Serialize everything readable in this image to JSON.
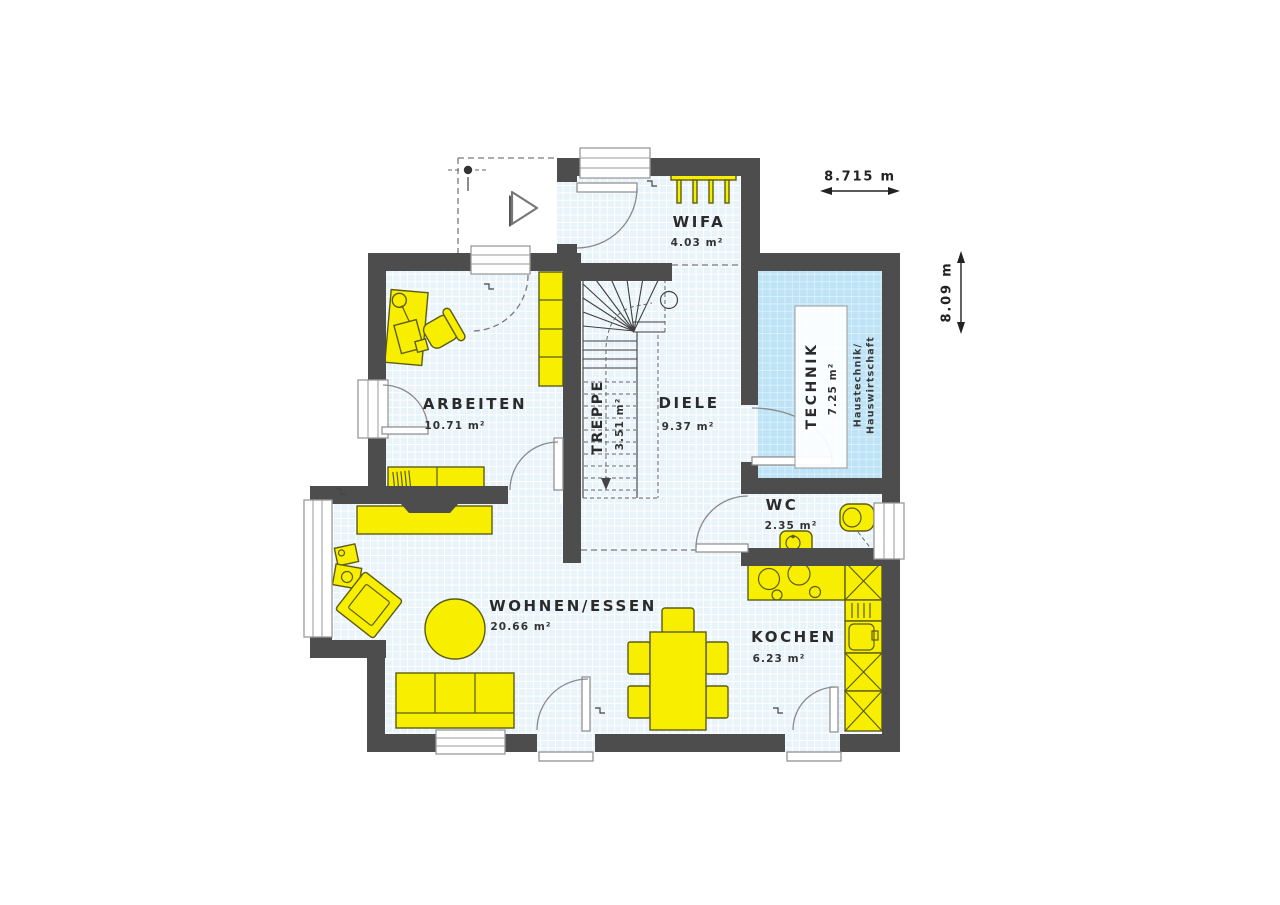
{
  "rooms": [
    {
      "id": "wifa",
      "name": "WIFA",
      "area": "4.03 m²"
    },
    {
      "id": "arbeiten",
      "name": "ARBEITEN",
      "area": "10.71 m²"
    },
    {
      "id": "treppe",
      "name": "TREPPE",
      "area": "3.51 m²"
    },
    {
      "id": "diele",
      "name": "DIELE",
      "area": "9.37 m²"
    },
    {
      "id": "technik",
      "name": "TECHNIK",
      "area": "7.25 m²",
      "note1": "Haustechnik/",
      "note2": "Hauswirtschaft"
    },
    {
      "id": "wc",
      "name": "WC",
      "area": "2.35 m²"
    },
    {
      "id": "wohnen",
      "name": "WOHNEN/ESSEN",
      "area": "20.66 m²"
    },
    {
      "id": "kochen",
      "name": "KOCHEN",
      "area": "6.23 m²"
    }
  ],
  "dimensions": {
    "width": "8.715 m",
    "height": "8.09 m"
  },
  "colors": {
    "wall": "#4d4d4d",
    "floor": "#e9f3fa",
    "floor_grid": "#ffffff",
    "technik_floor": "#bee3f6",
    "furniture": "#f8ee00",
    "furniture_outline": "#5c5c14",
    "text": "#2b2b2b"
  }
}
